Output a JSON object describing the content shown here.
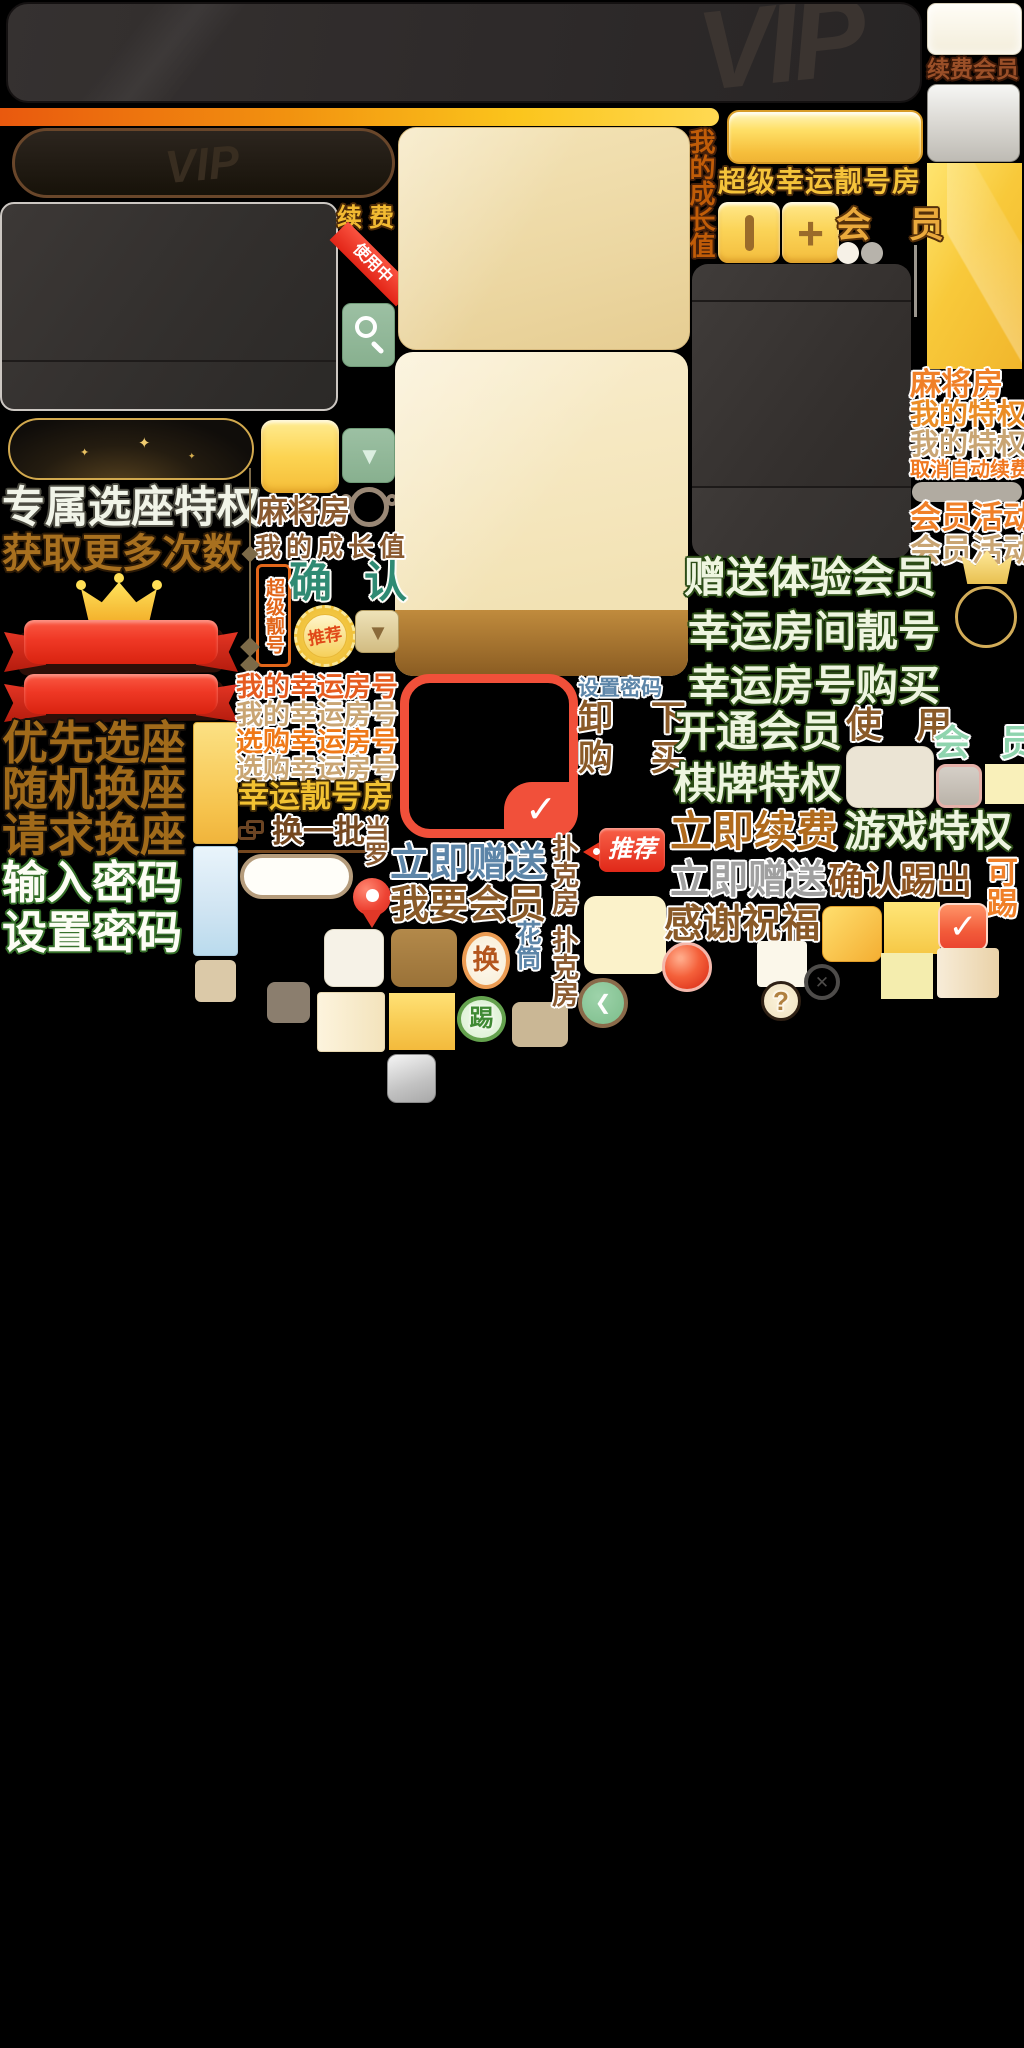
{
  "top": {
    "watermark": "VIP",
    "renew_member": "续费会员",
    "growth_value_vertical": "我的成长值",
    "super_lucky_room": "超级幸运靓号房"
  },
  "left": {
    "exclusive_seat": "专属选座特权",
    "get_more_times": "获取更多次数",
    "priority_seat": "优先选座",
    "random_swap_seat": "随机换座",
    "request_swap_seat": "请求换座",
    "enter_password": "输入密码",
    "set_password": "设置密码"
  },
  "middle": {
    "renew": "续 费",
    "in_use": "使用中",
    "mahjong_room": "麻将房",
    "growth_value": "我的成长值",
    "super_number_vertical": "超级靓号",
    "confirm": "确 认",
    "recommend_seal": "推荐",
    "recommend_tag": "推荐",
    "my_lucky_number_orange": "我的幸运房号",
    "my_lucky_number_tan": "我的幸运房号",
    "buy_lucky_number_orange": "选购幸运房号",
    "buy_lucky_number_tan": "选购幸运房号",
    "lucky_number_room": "幸运靓号房",
    "change_batch": "换一批",
    "vertical_pair_brown": "当罗",
    "give_now": "立即赠送",
    "want_member": "我要会员",
    "swap": "换",
    "kick": "踢",
    "vertical_pair_blue": "花筒",
    "poker_room_1": "扑克房",
    "poker_room_2": "扑克房",
    "set_password": "设置密码",
    "unload": "卸 下",
    "purchase": "购 买"
  },
  "right": {
    "member": "会 员",
    "mahjong_room": "麻将房",
    "my_privilege_gold": "我的特权",
    "my_privilege_tan": "我的特权",
    "cancel_auto_renew": "取消自动续费",
    "member_activity_orange": "会员活动",
    "member_activity_tan": "会员活动",
    "gift_trial_member": "赠送体验会员",
    "lucky_room_number": "幸运房间靓号",
    "lucky_number_buy": "幸运房号购买",
    "open_member": "开通会员",
    "use": "使 用",
    "member_mint": "会 员",
    "board_privilege": "棋牌特权",
    "game_privilege": "游戏特权",
    "renew_now": "立即续费",
    "give_now_gray": "立即赠送",
    "confirm_kick": "确认踢出",
    "kickable_vertical": "可踢",
    "thanks_blessing": "感谢祝福",
    "question_mark": "?"
  },
  "icons": {
    "check": "✓",
    "close": "✕",
    "chevron_left": "❮",
    "triangle_down": "▼",
    "sparkle": "✦",
    "plus": "+"
  },
  "colors": {
    "accent_gold": "#f2ba32",
    "accent_orange": "#ef7918",
    "brown": "#8a5a2b",
    "tan": "#c9a573",
    "teal": "#2f8a73",
    "blue": "#5c85a8",
    "pale_green": "#eef5e0",
    "green_outline": "#2c4d17",
    "red": "#f1503a"
  }
}
